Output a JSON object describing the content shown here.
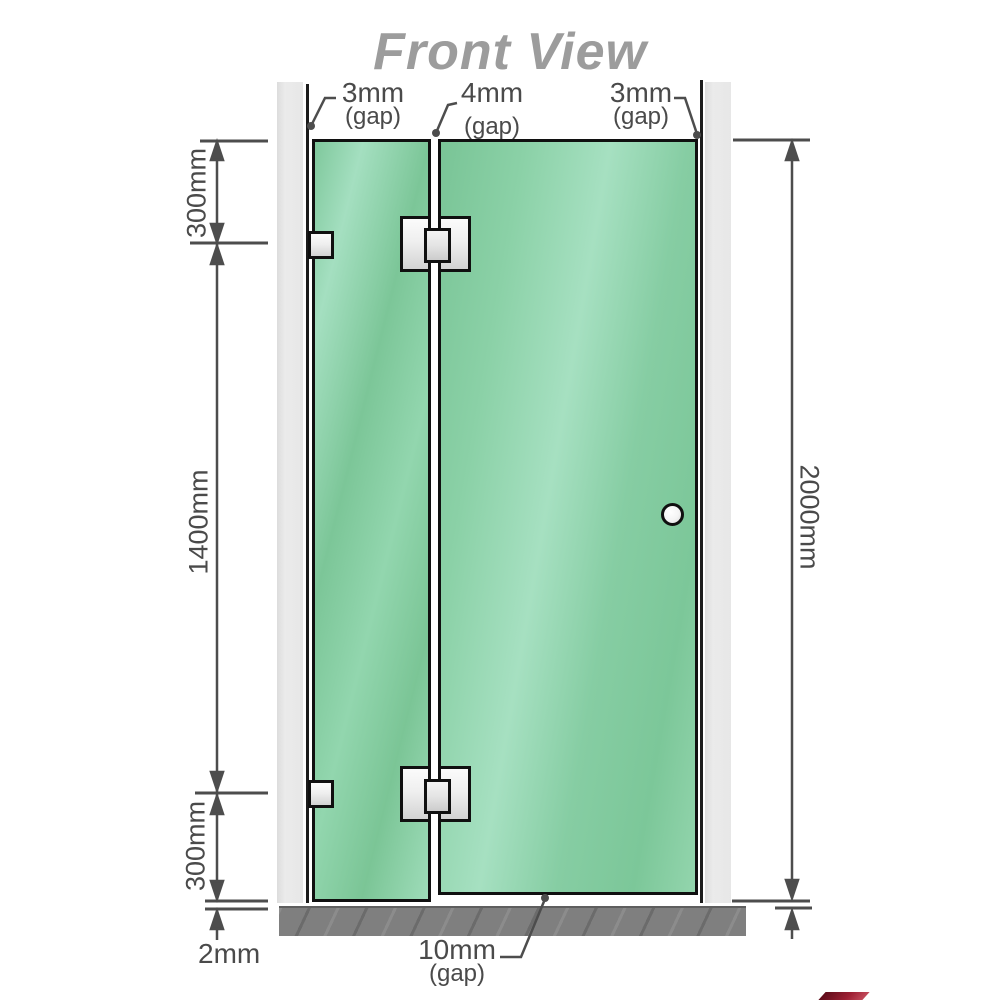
{
  "title": "Front View",
  "gaps": {
    "left": {
      "value": "3mm",
      "qualifier": "(gap)"
    },
    "middle": {
      "value": "4mm",
      "qualifier": "(gap)"
    },
    "right": {
      "value": "3mm",
      "qualifier": "(gap)"
    },
    "bottom": {
      "value": "10mm",
      "qualifier": "(gap)"
    }
  },
  "dimensions": {
    "top_segment": "300mm",
    "middle_segment": "1400mm",
    "bottom_segment": "300mm",
    "total_height": "2000mm",
    "floor_gap": "2mm"
  },
  "colors": {
    "glass_green": "#86cda4",
    "wall_gray": "#e7e7e7",
    "floor_gray": "#7f7f7f",
    "dimension_gray": "#4a4a4a",
    "title_gray": "#9c9c9c",
    "outline_black": "#101010"
  }
}
